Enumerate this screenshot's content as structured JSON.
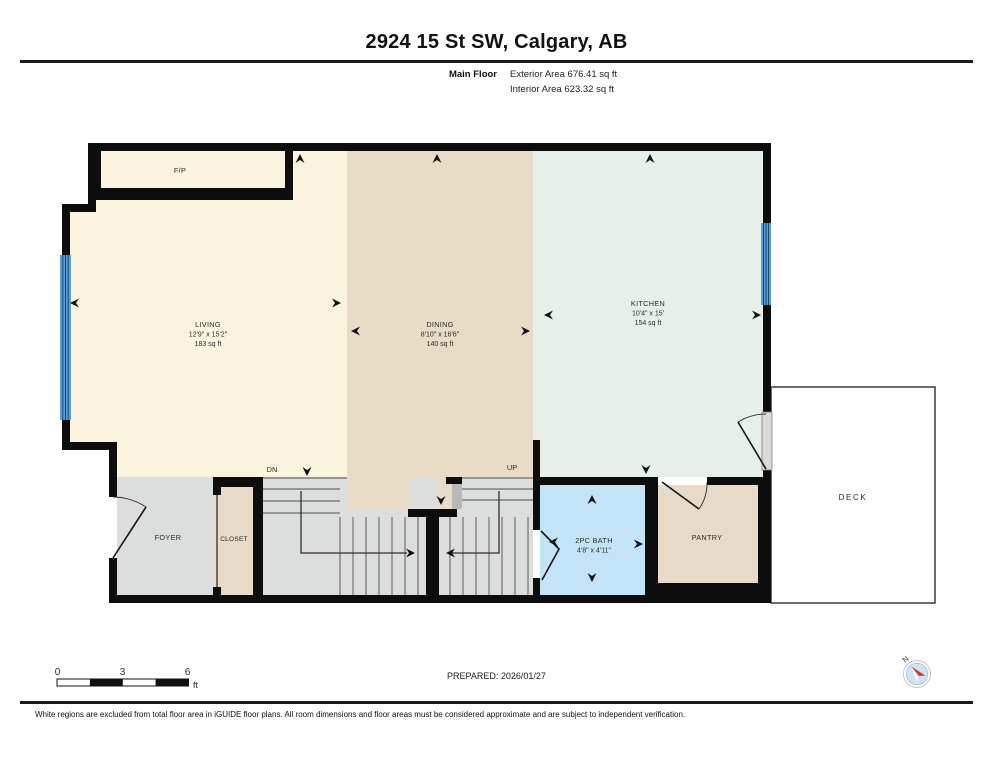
{
  "header": {
    "title": "2924 15 St SW, Calgary, AB",
    "floor_label": "Main Floor",
    "exterior_area": "Exterior Area 676.41 sq ft",
    "interior_area": "Interior Area 623.32 sq ft"
  },
  "rooms": {
    "living": {
      "name": "LIVING",
      "dims": "12'9\" x 15'2\"",
      "area": "183 sq ft"
    },
    "dining": {
      "name": "DINING",
      "dims": "8'10\" x 16'6\"",
      "area": "140 sq ft"
    },
    "kitchen": {
      "name": "KITCHEN",
      "dims": "10'4\" x 15'",
      "area": "154 sq ft"
    },
    "bath": {
      "name": "2PC BATH",
      "dims": "4'8\" x 4'11\""
    },
    "foyer": {
      "name": "FOYER"
    },
    "closet": {
      "name": "CLOSET"
    },
    "pantry": {
      "name": "PANTRY"
    },
    "deck": {
      "name": "DECK"
    },
    "fireplace": {
      "name": "F/P"
    }
  },
  "stairs": {
    "down_label": "DN",
    "up_label": "UP"
  },
  "scale_bar": {
    "tick_0": "0",
    "tick_mid": "3",
    "tick_end": "6",
    "unit": "ft"
  },
  "footer": {
    "prepared": "PREPARED: 2026/01/27",
    "disclaimer": "White regions are excluded from total floor area in iGUIDE floor plans. All room dimensions and floor areas must be considered approximate and are subject to independent verification."
  },
  "compass": {
    "north_label": "N"
  },
  "colors": {
    "living": "#faf3dd",
    "dining": "#e9dcc6",
    "dining_patch": "#e9dcc6",
    "kitchen": "#e6efe8",
    "hall_gray": "#dcdddd",
    "closet_tan": "#e7dac7",
    "pantry_tan": "#e7dac7",
    "bath_blue": "#c3e3f8",
    "window_blue": "#5b9fd6",
    "deck_fill": "#ffffff"
  }
}
